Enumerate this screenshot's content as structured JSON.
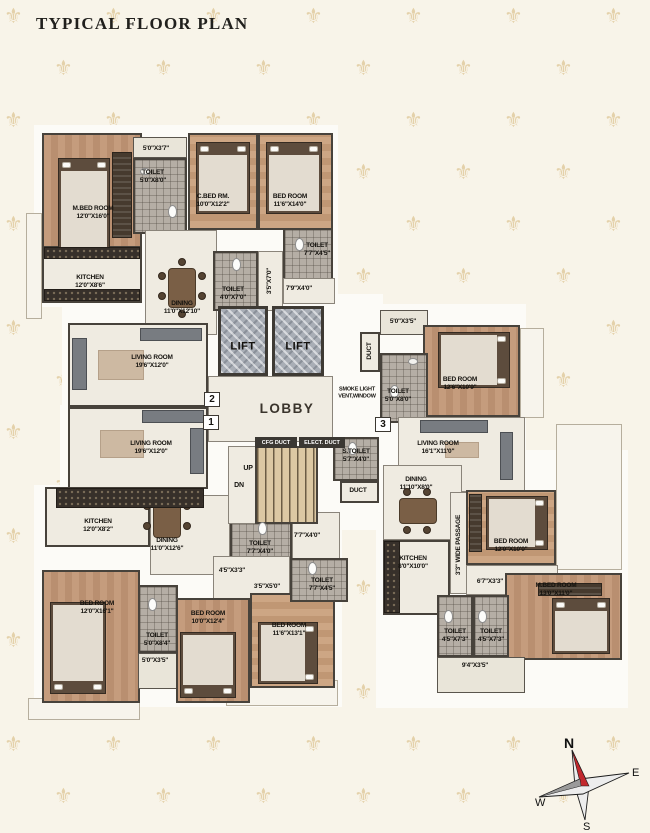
{
  "title": "TYPICAL FLOOR PLAN",
  "background": {
    "motif": "⚜",
    "rows": 17,
    "cols": 7
  },
  "compass": {
    "n": "N",
    "e": "E",
    "s": "S",
    "w": "W"
  },
  "core": {
    "lift": "LIFT",
    "lobby": "LOBBY",
    "smoke_line1": "SMOKE LIGHT",
    "smoke_line2": "VENT,WINDOW",
    "cfg_duct": "CFG DUCT",
    "elect_duct": "ELECT. DUCT",
    "up": "UP",
    "dn": "DN",
    "s_toilet": {
      "name": "S.TOILET",
      "dims": "5'7\"X4'0\""
    },
    "duct": "DUCT"
  },
  "units": {
    "u2": {
      "badge": "2",
      "mbed": {
        "name": "M.BED ROOM",
        "dims": "12'0\"X16'0\""
      },
      "balc1": {
        "dims": "5'0\"X3'7\""
      },
      "toilet1": {
        "name": "TOILET",
        "dims": "5'0\"X8'0\""
      },
      "cbed": {
        "name": "C.BED RM.",
        "dims": "10'0\"X12'2\""
      },
      "bed2": {
        "name": "BED ROOM",
        "dims": "11'6\"X14'0\""
      },
      "toilet2": {
        "name": "TOILET",
        "dims": "7'7\"X4'5\""
      },
      "pass1": {
        "dims": "7'9\"X4'0\""
      },
      "kitchen": {
        "name": "KITCHEN",
        "dims": "12'0\"X8'6\""
      },
      "dining": {
        "name": "DINING",
        "dims": "11'0\"X12'10\""
      },
      "toilet3": {
        "name": "TOILET",
        "dims": "4'0\"X7'0\""
      },
      "pass2": {
        "dims": "3'5\"X7'0\""
      },
      "living": {
        "name": "LIVING ROOM",
        "dims": "19'6\"X12'0\""
      }
    },
    "u1": {
      "badge": "1",
      "living": {
        "name": "LIVING ROOM",
        "dims": "19'6\"X12'0\""
      },
      "kitchen": {
        "name": "KITCHEN",
        "dims": "12'0\"X8'2\""
      },
      "dining": {
        "name": "DINING",
        "dims": "11'0\"X12'6\""
      },
      "toilet1": {
        "name": "TOILET",
        "dims": "7'7\"X4'0\""
      },
      "pass1": {
        "dims": "7'7\"X4'0\""
      },
      "pass2": {
        "dims": "4'5\"X3'3\""
      },
      "pass3": {
        "dims": "3'5\"X5'0\""
      },
      "bed1": {
        "name": "BED ROOM",
        "dims": "12'0\"X16'1\""
      },
      "toilet2": {
        "name": "TOILET",
        "dims": "5'0\"X8'4\""
      },
      "balc1": {
        "dims": "5'0\"X3'5\""
      },
      "bed2": {
        "name": "BED ROOM",
        "dims": "10'0\"X12'4\""
      },
      "bed3": {
        "name": "BED ROOM",
        "dims": "11'6\"X13'1\""
      },
      "toilet3": {
        "name": "TOILET",
        "dims": "7'7\"X4'5\""
      }
    },
    "u3": {
      "badge": "3",
      "balc1": {
        "dims": "5'0\"X3'5\""
      },
      "bed1": {
        "name": "BED ROOM",
        "dims": "12'6\"X10'9\""
      },
      "toilet1": {
        "name": "TOILET",
        "dims": "5'0\"X8'0\""
      },
      "living": {
        "name": "LIVING ROOM",
        "dims": "16'1\"X11'0\""
      },
      "dining": {
        "name": "DINING",
        "dims": "11'10\"X8'0\""
      },
      "kitchen": {
        "name": "KITCHEN",
        "dims": "8'0\"X10'0\""
      },
      "passage": {
        "dims": "3'3\" WIDE PASSAGE"
      },
      "bed2": {
        "name": "BED ROOM",
        "dims": "12'0\"X10'0\""
      },
      "pass2": {
        "dims": "6'7\"X3'3\""
      },
      "mbed": {
        "name": "M.BED ROOM",
        "dims": "13'0\"X11'0\""
      },
      "toilet2": {
        "name": "TOILET",
        "dims": "4'5\"X7'3\""
      },
      "toilet3": {
        "name": "TOILET",
        "dims": "4'5\"X7'3\""
      },
      "balc2": {
        "dims": "9'4\"X3'5\""
      }
    }
  }
}
